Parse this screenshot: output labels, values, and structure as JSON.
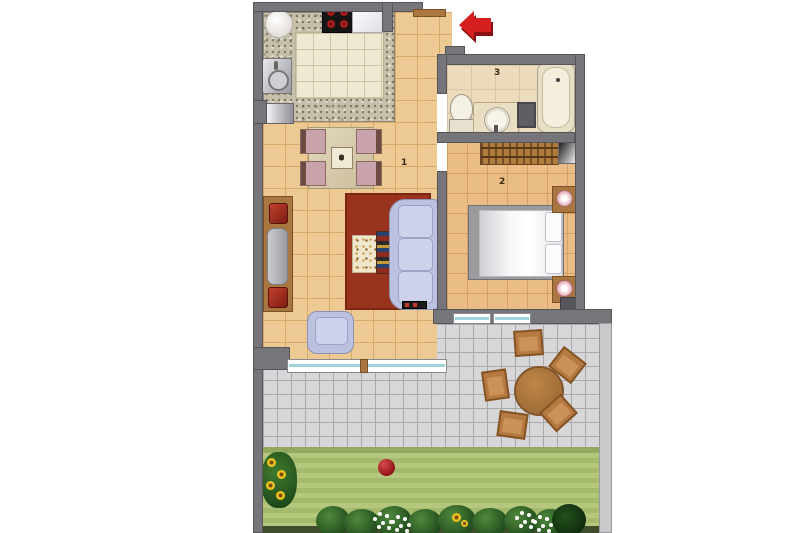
{
  "plan": {
    "type": "apartment-floor-plan",
    "rooms": [
      {
        "id": "living-dining",
        "label": "1"
      },
      {
        "id": "bedroom",
        "label": "2"
      },
      {
        "id": "bathroom",
        "label": "3"
      }
    ],
    "entrance_marker": "red-left-pointing-arrow",
    "outdoor_areas": [
      "terrace",
      "garden"
    ]
  },
  "furniture": {
    "kitchen": [
      "round-counter-top",
      "cooktop-4-burners",
      "worktop",
      "sink",
      "dishwasher",
      "granite-counter"
    ],
    "living_dining": [
      "dining-table",
      "dining-chairs-x4",
      "sideboard-with-tv",
      "sofa",
      "armchair",
      "coffee-mat",
      "patterned-runner",
      "red-rug"
    ],
    "bedroom": [
      "double-bed",
      "nightstand-with-lamp-x2",
      "wardrobe",
      "mirror",
      "ac-unit"
    ],
    "bathroom": [
      "toilet",
      "vanity-sink",
      "cabinet",
      "bathtub"
    ],
    "terrace": [
      "round-table",
      "chairs-x5"
    ],
    "garden": [
      "lawn",
      "red-ball",
      "sunflower-bush",
      "flower-hedge"
    ]
  },
  "colors": {
    "wall": "#76767a",
    "living_floor": "#edc993",
    "bedroom_floor": "#e9bd85",
    "bathroom_floor": "#ecdbbc",
    "kitchen_tile": "#ede9d2",
    "counter_granite": "#c6bfa9",
    "terrace_tile": "#d7d7d9",
    "grass": "#aec374",
    "hedge": "#1f481b",
    "sofa": "#bcc1e0",
    "rug_red": "#98341d",
    "wood": "#a9763f",
    "entrance_arrow": "#d62020",
    "glass_teal": "#9fd4da"
  }
}
